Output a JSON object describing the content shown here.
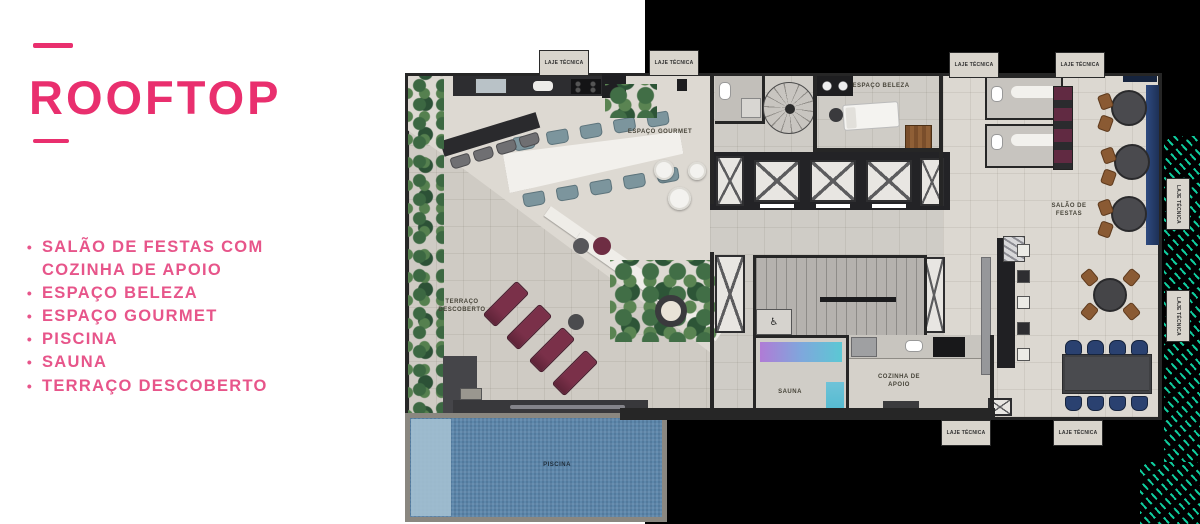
{
  "panel": {
    "bullet": "•",
    "title": "ROOFTOP",
    "amenities": [
      "SALÃO DE FESTAS COM COZINHA DE APOIO",
      "ESPAÇO BELEZA",
      "ESPAÇO GOURMET",
      "PISCINA",
      "SAUNA",
      "TERRAÇO DESCOBERTO"
    ]
  },
  "plan": {
    "labels": {
      "espaco_gourmet": "ESPAÇO GOURMET",
      "espaco_beleza": "ESPAÇO BELEZA",
      "salao_de_festas": "SALÃO DE FESTAS",
      "terraco_descoberto": "TERRAÇO DESCOBERTO",
      "cozinha_de_apoio": "COZINHA DE APOIO",
      "sauna": "SAUNA",
      "piscina": "PISCINA",
      "laje_tecnica": "LAJE TÉCNICA"
    },
    "icons": {
      "wheelchair": "♿"
    }
  },
  "colors": {
    "accent_pink": "#e92f6e",
    "list_pink": "#e7558a",
    "background_black": "#000000",
    "panel_white": "#ffffff",
    "floor_beige": "#d8d4cd",
    "wall_dark": "#262626",
    "pool_blue": "#5d87ab",
    "pool_shallow_blue": "#a3c0d1",
    "sauna_gradient": [
      "#b07bd6",
      "#7fa7dc",
      "#5bc8d4"
    ],
    "circuit_teal": "#10d6a5",
    "lounger_maroon": "#6e2d43",
    "chair_navy": "#2a4170",
    "chair_teal_gray": "#7c959d",
    "wood_brown": "#8a5a33"
  }
}
